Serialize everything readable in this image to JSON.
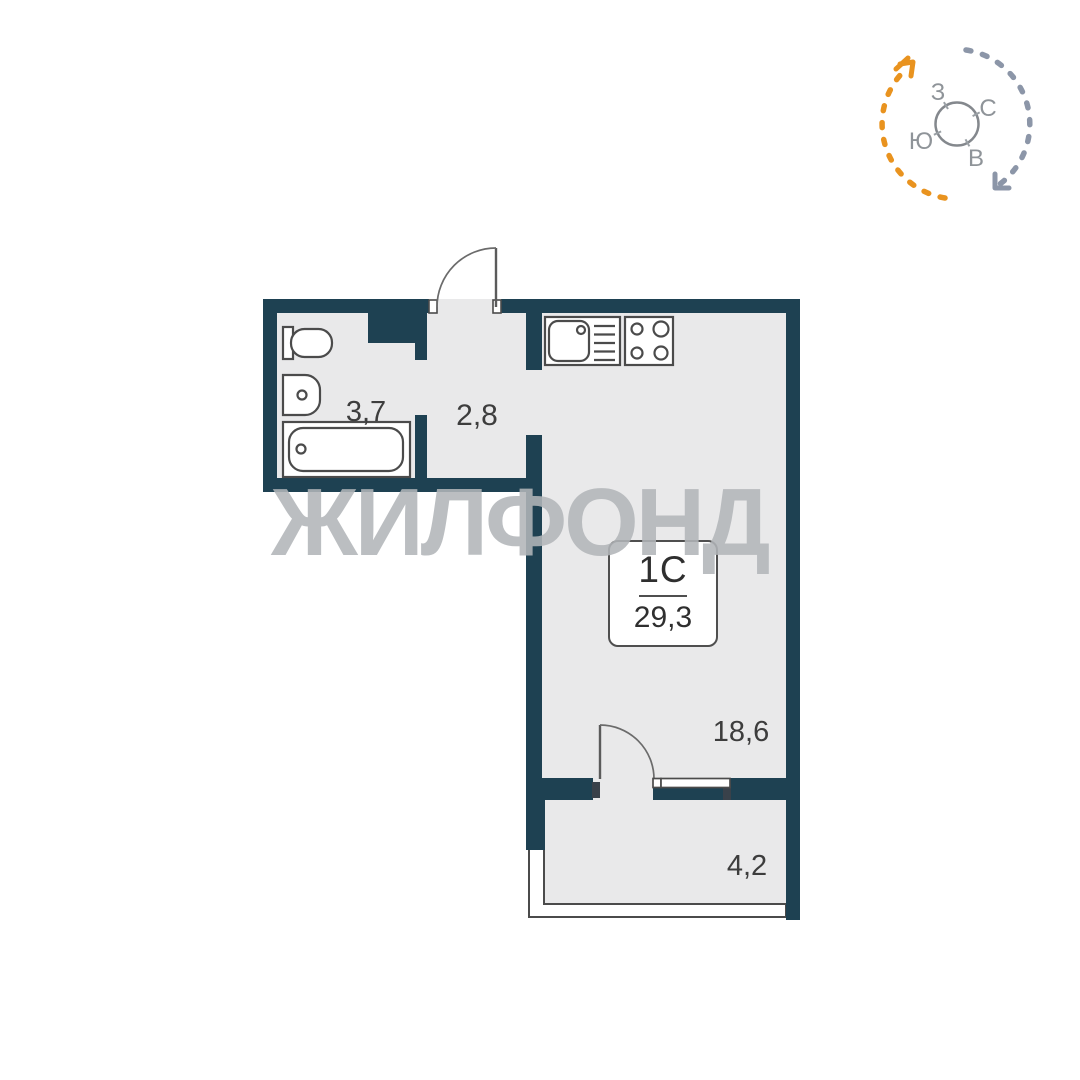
{
  "watermark": "ЖИЛФОНД",
  "unit": {
    "type_label": "1С",
    "total_area": "29,3"
  },
  "rooms": {
    "bathroom": {
      "area": "3,7"
    },
    "hallway": {
      "area": "2,8"
    },
    "living_room": {
      "area": "18,6"
    },
    "balcony": {
      "area": "4,2"
    }
  },
  "compass": {
    "north": "С",
    "south": "Ю",
    "west": "З",
    "east": "В"
  },
  "colors": {
    "wall": "#1e4152",
    "floor": "#e9e9ea",
    "outline": "#4b4b4b",
    "label_text": "#3d3d3d",
    "watermark": "rgba(178,181,184,0.88)",
    "compass_orange": "#e9931f",
    "compass_gray": "#8c96a8",
    "compass_ring": "#84888d",
    "compass_text": "#8f9499"
  }
}
